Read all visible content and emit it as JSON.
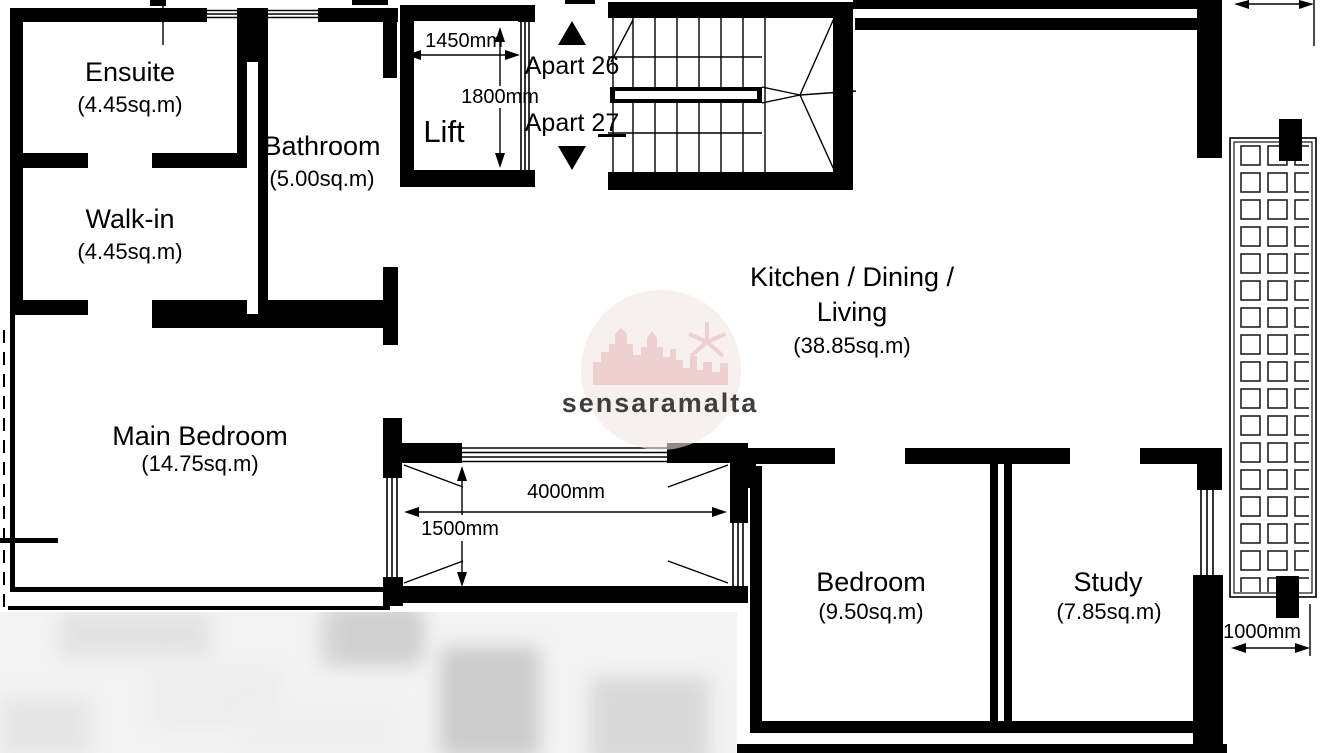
{
  "plan": {
    "rooms": {
      "ensuite": {
        "name": "Ensuite",
        "area": "(4.45sq.m)"
      },
      "bathroom": {
        "name": "Bathroom",
        "area": "(5.00sq.m)"
      },
      "walk_in": {
        "name": "Walk-in",
        "area": "(4.45sq.m)"
      },
      "lift": {
        "name": "Lift"
      },
      "kitchen": {
        "name_line1": "Kitchen / Dining /",
        "name_line2": "Living",
        "area": "(38.85sq.m)"
      },
      "main_bedroom": {
        "name": "Main Bedroom",
        "area": "(14.75sq.m)"
      },
      "bedroom": {
        "name": "Bedroom",
        "area": "(9.50sq.m)"
      },
      "study": {
        "name": "Study",
        "area": "(7.85sq.m)"
      }
    },
    "dimensions": {
      "lift_width": "1450mm",
      "lift_depth": "1800mm",
      "terrace_width": "4000mm",
      "terrace_depth": "1500mm",
      "balcony_width": "1000mm"
    },
    "stair_labels": {
      "up": "Apart 26",
      "down": "Apart 27"
    }
  },
  "watermark": {
    "text": "sensaramalta"
  },
  "colors": {
    "wall": "#000000",
    "background": "#ffffff",
    "watermark_fill": "#f4e3e3",
    "watermark_accent": "#e6bebe",
    "watermark_text": "#dcaaaa"
  }
}
